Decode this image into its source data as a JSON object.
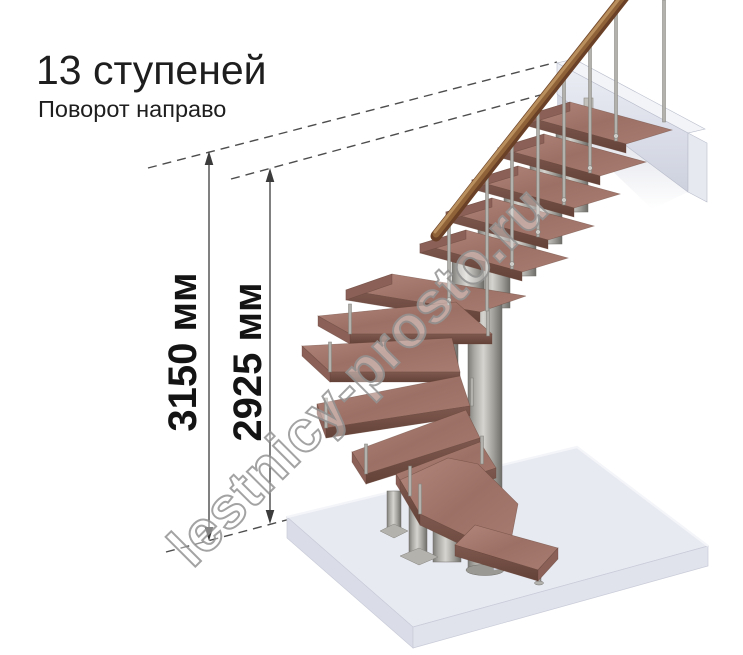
{
  "header": {
    "title": "13 ступеней",
    "subtitle": "Поворот направо"
  },
  "dimensions": {
    "total_height_label": "3150 мм",
    "flight_height_label": "2925 мм"
  },
  "watermark": {
    "text": "lestnicy-prosto.ru"
  },
  "stair": {
    "steps": "13",
    "turn": "направо"
  },
  "colors": {
    "wood_top": "#a5786f",
    "wood_front": "#6f4b41",
    "metal": "#b3b1ac",
    "rail": "#6a4126",
    "floor": "#e8eaf2",
    "wall": "#dde1ec",
    "dim_line": "#3c3c3c",
    "text": "#1e1e1e",
    "watermark_stroke": "#949494"
  }
}
